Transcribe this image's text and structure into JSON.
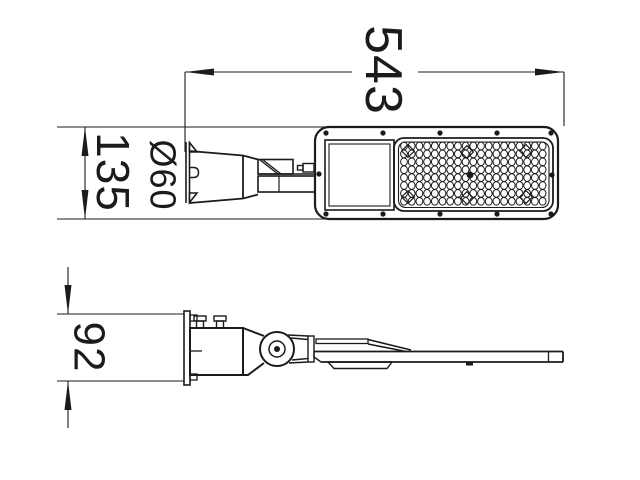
{
  "drawing": {
    "background": "#ffffff",
    "line_color": "#1b1b1b",
    "dimensions": {
      "overall_length": "543",
      "body_width": "135",
      "pole_diameter": "Ø60",
      "body_height": "92"
    },
    "lens_grid": {
      "rows": 8,
      "cols": 19
    }
  }
}
